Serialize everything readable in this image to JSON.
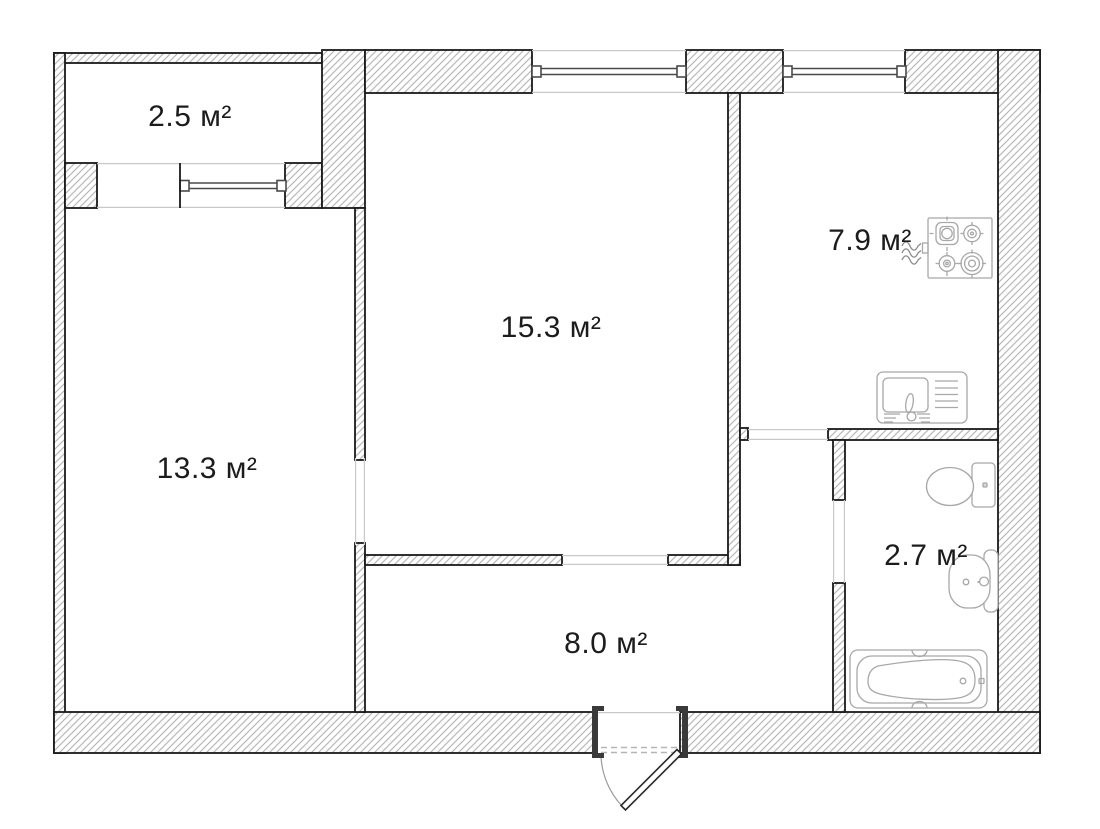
{
  "plan": {
    "rooms": [
      {
        "id": "balcony",
        "area_label": "2.5 м²"
      },
      {
        "id": "living-room",
        "area_label": "15.3 м²"
      },
      {
        "id": "kitchen",
        "area_label": "7.9 м²"
      },
      {
        "id": "bedroom",
        "area_label": "13.3 м²"
      },
      {
        "id": "bathroom",
        "area_label": "2.7 м²"
      },
      {
        "id": "hallway",
        "area_label": "8.0 м²"
      }
    ],
    "fixtures": [
      "stove-icon",
      "kitchen-sink-icon",
      "toilet-icon",
      "washbasin-icon",
      "bathtub-icon",
      "gas-supply-icon",
      "entrance-door-icon"
    ],
    "windows_count": 3,
    "colors": {
      "background": "#ffffff",
      "wall_outline": "#1a1a1a",
      "wall_hatch": "#b9b9b9",
      "fixture_stroke": "#a8a8a8",
      "opening_line": "#c9c9c9",
      "text": "#1c1c1c"
    }
  }
}
